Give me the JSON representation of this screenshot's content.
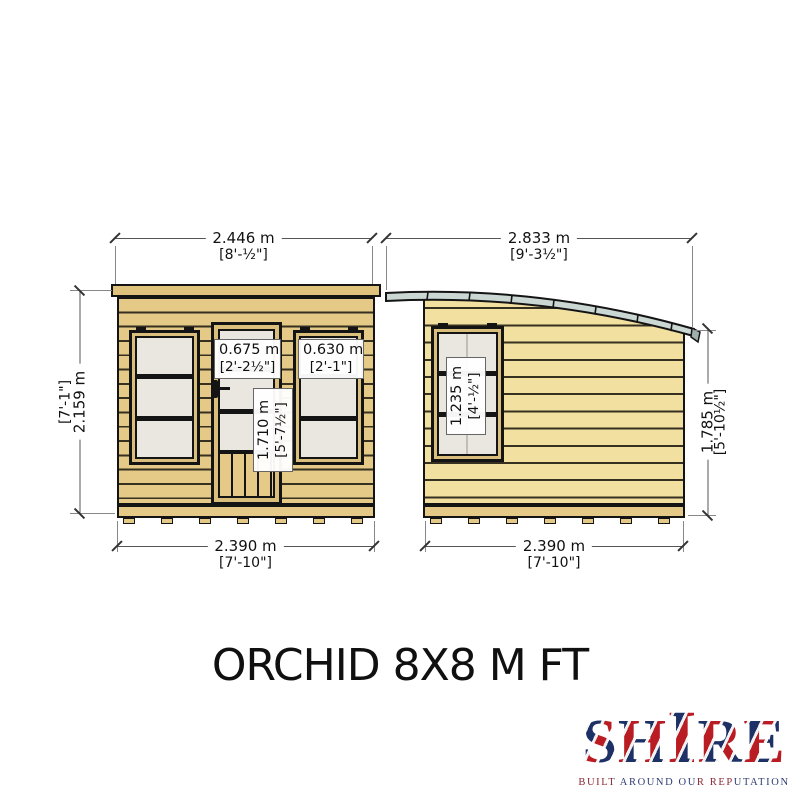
{
  "title": "ORCHID 8X8 M FT",
  "brand": {
    "name": "SHIRE",
    "letters": [
      "S",
      "H",
      "I",
      "R",
      "E"
    ],
    "tagline": "BUILT AROUND OUR REPUTATION"
  },
  "dims": {
    "front_width": {
      "metric": "2.446 m",
      "imperial": "[8'-½\"]"
    },
    "side_width": {
      "metric": "2.833 m",
      "imperial": "[9'-3½\"]"
    },
    "front_height": {
      "metric": "2.159 m",
      "imperial": "[7'-1\"]"
    },
    "side_height": {
      "metric": "1.785 m",
      "imperial": "[5'-10½\"]"
    },
    "front_base_width": {
      "metric": "2.390 m",
      "imperial": "[7'-10\"]"
    },
    "side_base_width": {
      "metric": "2.390 m",
      "imperial": "[7'-10\"]"
    },
    "door_width": {
      "metric": "0.675 m",
      "imperial": "[2'-2½\"]"
    },
    "front_window_width": {
      "metric": "0.630 m",
      "imperial": "[2'-1\"]"
    },
    "door_height": {
      "metric": "1.710 m",
      "imperial": "[5'-7½\"]"
    },
    "side_window_height": {
      "metric": "1.235 m",
      "imperial": "[4'-½\"]"
    }
  },
  "colors": {
    "cladding_front": "#e4c987",
    "cladding_side": "#f1e0a0",
    "roof": "#cbd7d3",
    "pane": "#eae7e0",
    "frame": "#141414",
    "brand_blue": "#1d3166",
    "brand_red": "#b91c22"
  }
}
